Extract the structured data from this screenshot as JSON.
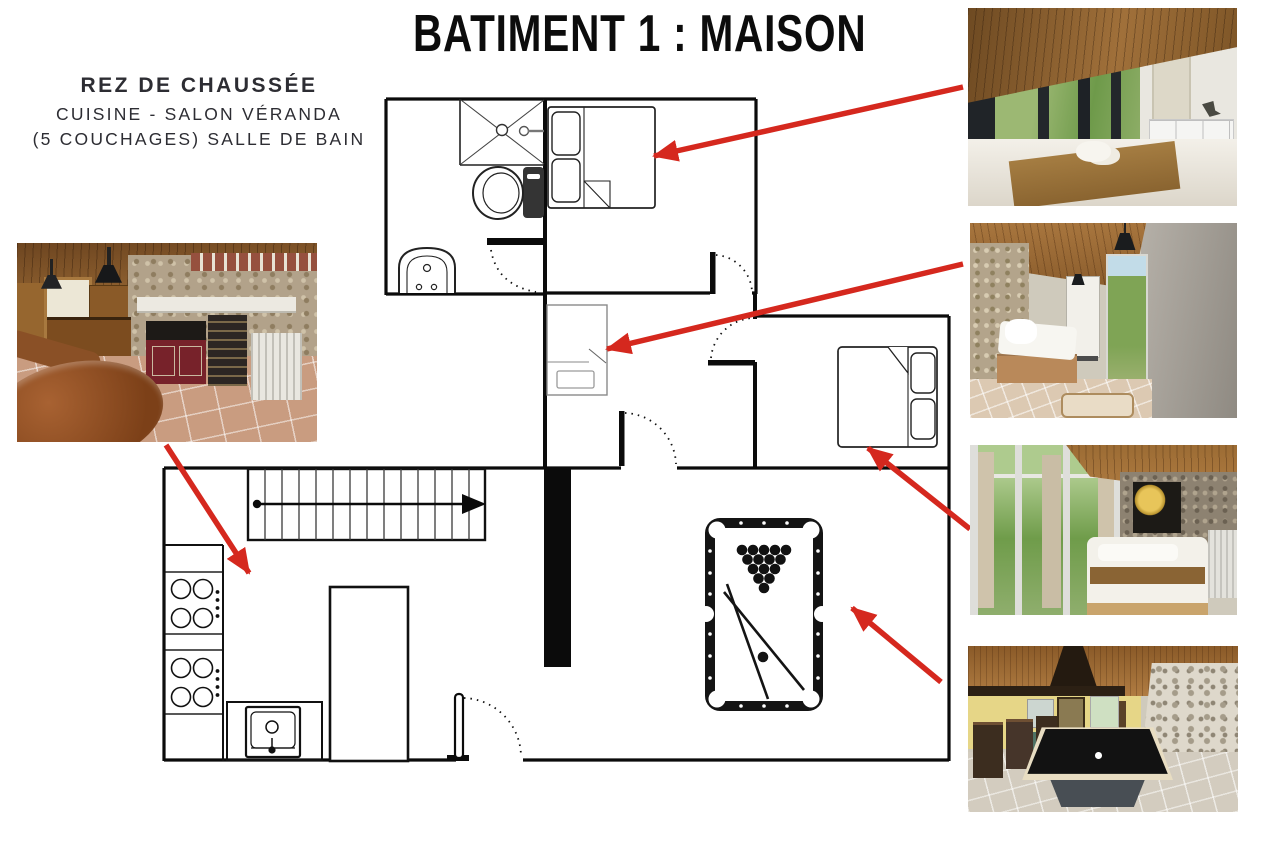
{
  "title": "BATIMENT 1 : MAISON",
  "subtitle": {
    "line1": "REZ DE CHAUSSÉE",
    "line2": "CUISINE - SALON VÉRANDA",
    "line3": "(5 COUCHAGES) SALLE DE BAIN"
  },
  "colors": {
    "background": "#ffffff",
    "walls": "#0b0b0b",
    "arrow_red": "#d5281e",
    "light_outline": "#888888"
  }
}
